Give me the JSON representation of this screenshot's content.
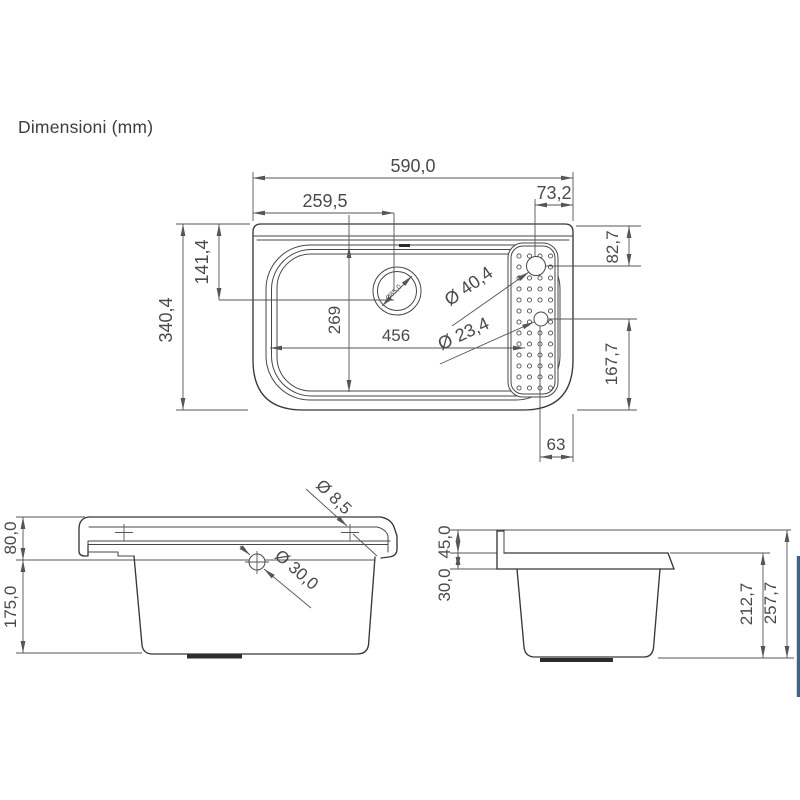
{
  "title": "Dimensioni (mm)",
  "colors": {
    "line": "#38383a",
    "dim_text": "#4a4a4e",
    "accent_blue": "#3a6191"
  },
  "top_view": {
    "overall_width": "590,0",
    "drain_center_from_left": "259,5",
    "tap_center_from_right_edge": "73,2",
    "drain_center_from_top": "141,4",
    "overall_depth": "340,4",
    "tap_center_from_top": "82,7",
    "basin_inner_depth": "269",
    "basin_inner_width": "456",
    "tap_hole_diameter": "Ø 40,4",
    "overflow_hole_diameter": "Ø 23,4",
    "drain_hole_diameter": "Ø85,0",
    "overflow_to_bottom": "167,7",
    "overflow_from_right_edge": "63"
  },
  "front_view": {
    "rim_height": "80,0",
    "bowl_height": "175,0",
    "fixing_hole_diameter": "Ø 8,5",
    "side_hole_diameter": "Ø 30,0"
  },
  "side_view": {
    "backsplash_height": "45,0",
    "rim_thickness": "30,0",
    "bowl_depth": "212,7",
    "overall_height": "257,7"
  }
}
